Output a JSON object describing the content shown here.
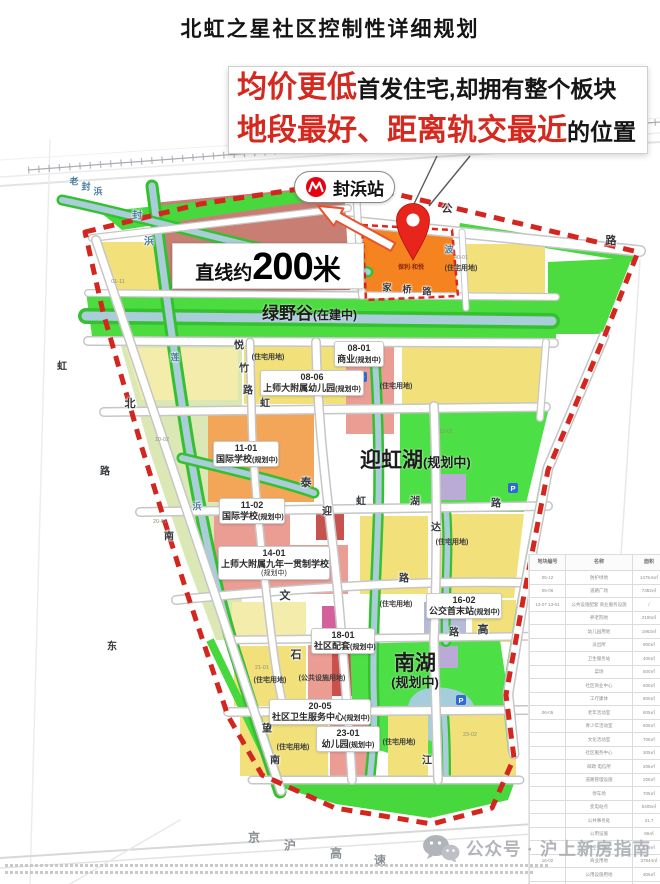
{
  "page_title": "北虹之星社区控制性详细规划",
  "callout": {
    "line1_red": "均价更低",
    "line1_black": "首发住宅,却拥有整个板块",
    "line2_red": "地段最好、距离轨交最近",
    "line2_black": "的位置"
  },
  "station": {
    "label": "封浜站"
  },
  "distance_box": {
    "prefix": "直线约",
    "number": "200",
    "unit": "米"
  },
  "area_labels": {
    "green_valley": {
      "name": "绿野谷",
      "status": "(在建中)"
    },
    "yinghong_lake": {
      "name": "迎虹湖",
      "status": "(规划中)"
    },
    "south_lake": {
      "name": "南湖",
      "status": "(规划中)"
    }
  },
  "highlight_parcel": {
    "text": "保利·和悦"
  },
  "parcel_labels": [
    {
      "code": "08-01",
      "name": "商业",
      "status": "(规划中)",
      "x": 334,
      "y": 341,
      "w": 50,
      "stack": false
    },
    {
      "code": "08-06",
      "name": "上师大附属幼儿园",
      "status": "(规划中)",
      "x": 260,
      "y": 370,
      "w": 104,
      "stack": false
    },
    {
      "code": "11-01",
      "name": "国际学校",
      "status": "(规划中)",
      "x": 213,
      "y": 441,
      "w": 66,
      "stack": false
    },
    {
      "code": "11-02",
      "name": "国际学校",
      "status": "(规划中)",
      "x": 219,
      "y": 498,
      "w": 66,
      "stack": false
    },
    {
      "code": "14-01",
      "name": "上师大附属九年一贯制学校",
      "status": "(规划中)",
      "x": 218,
      "y": 546,
      "w": 112,
      "stack": true
    },
    {
      "code": "16-02",
      "name": "公交首末站",
      "status": "(规划中)",
      "x": 426,
      "y": 593,
      "w": 76,
      "stack": false
    },
    {
      "code": "18-01",
      "name": "社区配套",
      "status": "(规划中)",
      "x": 311,
      "y": 628,
      "w": 64,
      "stack": false
    },
    {
      "code": "20-05",
      "name": "社区卫生服务中心",
      "status": "(规划中)",
      "x": 269,
      "y": 699,
      "w": 102,
      "stack": false
    },
    {
      "code": "23-01",
      "name": "幼儿园",
      "status": "(规划中)",
      "x": 316,
      "y": 726,
      "w": 64,
      "stack": false
    }
  ],
  "land_use_labels": [
    {
      "text": "(住宅用地)",
      "x": 268,
      "y": 357
    },
    {
      "text": "(住宅用地)",
      "x": 396,
      "y": 386
    },
    {
      "text": "(住宅用地)",
      "x": 461,
      "y": 268
    },
    {
      "text": "(住宅用地)",
      "x": 452,
      "y": 542
    },
    {
      "text": "(住宅用地)",
      "x": 396,
      "y": 604
    },
    {
      "text": "(住宅用地)",
      "x": 270,
      "y": 680
    },
    {
      "text": "(住宅用地)",
      "x": 293,
      "y": 747
    },
    {
      "text": "(住宅用地)",
      "x": 399,
      "y": 742
    },
    {
      "text": "(公共设施用地)",
      "x": 322,
      "y": 678
    }
  ],
  "parcel_codes": [
    [
      "01-11",
      118,
      282
    ],
    [
      "40-01",
      461,
      258
    ],
    [
      "10-02",
      162,
      440
    ],
    [
      "20-01",
      160,
      522
    ],
    [
      "12-01",
      446,
      432
    ],
    [
      "21-01",
      262,
      668
    ],
    [
      "23-02",
      470,
      735
    ]
  ],
  "road_chars": [
    {
      "c": "老",
      "x": 74,
      "y": 181,
      "s": 9,
      "w": true
    },
    {
      "c": "封",
      "x": 86,
      "y": 186,
      "s": 9,
      "w": true
    },
    {
      "c": "浜",
      "x": 98,
      "y": 191,
      "s": 9,
      "w": true
    },
    {
      "c": "封",
      "x": 137,
      "y": 214,
      "s": 10,
      "w": true
    },
    {
      "c": "浜",
      "x": 149,
      "y": 240,
      "s": 10,
      "w": true
    },
    {
      "c": "公",
      "x": 447,
      "y": 208,
      "s": 11
    },
    {
      "c": "路",
      "x": 611,
      "y": 240,
      "s": 11
    },
    {
      "c": "波",
      "x": 449,
      "y": 249,
      "s": 9,
      "w": true
    },
    {
      "c": "家",
      "x": 387,
      "y": 287,
      "s": 9
    },
    {
      "c": "桥",
      "x": 407,
      "y": 289,
      "s": 9
    },
    {
      "c": "路",
      "x": 427,
      "y": 291,
      "s": 9
    },
    {
      "c": "莲",
      "x": 175,
      "y": 357,
      "s": 9,
      "w": true
    },
    {
      "c": "浜",
      "x": 197,
      "y": 506,
      "s": 9,
      "w": true
    },
    {
      "c": "悦",
      "x": 239,
      "y": 344,
      "s": 10
    },
    {
      "c": "竹",
      "x": 244,
      "y": 367,
      "s": 10
    },
    {
      "c": "路",
      "x": 248,
      "y": 389,
      "s": 10
    },
    {
      "c": "虹",
      "x": 62,
      "y": 365,
      "s": 10
    },
    {
      "c": "路",
      "x": 105,
      "y": 470,
      "s": 10
    },
    {
      "c": "北",
      "x": 130,
      "y": 403,
      "s": 11
    },
    {
      "c": "南",
      "x": 169,
      "y": 535,
      "s": 10
    },
    {
      "c": "虹",
      "x": 265,
      "y": 402,
      "s": 10
    },
    {
      "c": "泰",
      "x": 306,
      "y": 482,
      "s": 11
    },
    {
      "c": "迎",
      "x": 327,
      "y": 510,
      "s": 10
    },
    {
      "c": "虹",
      "x": 361,
      "y": 500,
      "s": 10
    },
    {
      "c": "湖",
      "x": 415,
      "y": 500,
      "s": 10
    },
    {
      "c": "达",
      "x": 436,
      "y": 526,
      "s": 10
    },
    {
      "c": "路",
      "x": 496,
      "y": 502,
      "s": 10
    },
    {
      "c": "文",
      "x": 285,
      "y": 595,
      "s": 11
    },
    {
      "c": "路",
      "x": 404,
      "y": 577,
      "s": 10
    },
    {
      "c": "石",
      "x": 296,
      "y": 654,
      "s": 11
    },
    {
      "c": "高",
      "x": 483,
      "y": 629,
      "s": 11
    },
    {
      "c": "路",
      "x": 454,
      "y": 631,
      "s": 10
    },
    {
      "c": "望",
      "x": 267,
      "y": 727,
      "s": 10
    },
    {
      "c": "江",
      "x": 359,
      "y": 711,
      "s": 10
    },
    {
      "c": "江",
      "x": 427,
      "y": 759,
      "s": 10
    },
    {
      "c": "南",
      "x": 275,
      "y": 759,
      "s": 10
    },
    {
      "c": "东",
      "x": 112,
      "y": 645,
      "s": 10
    }
  ],
  "expressway_chars": [
    [
      "京",
      254,
      837
    ],
    [
      "沪",
      290,
      845
    ],
    [
      "高",
      336,
      853
    ],
    [
      "速",
      380,
      860
    ]
  ],
  "watermark": {
    "text": "公众号 · 沪上新房指南"
  },
  "legend": {
    "headers": [
      "地块编号",
      "名称",
      "面积"
    ],
    "rows": [
      {
        "a": "05-12",
        "b": "防护绿地",
        "c": "1479.6㎡"
      },
      {
        "a": "05-06",
        "b": "道路广场",
        "c": "7352㎡"
      },
      {
        "a": "13-07 13-01",
        "b": "公共设施配套 商业服务设施",
        "c": "/"
      },
      {
        "a": "",
        "b": "养老院地",
        "c": "2100㎡"
      },
      {
        "a": "",
        "b": "幼儿园用地",
        "c": "1963㎡"
      },
      {
        "a": "",
        "b": "派出所",
        "c": "900㎡"
      },
      {
        "a": "",
        "b": "卫生服务站",
        "c": "400㎡"
      },
      {
        "a": "",
        "b": "菜场",
        "c": "500㎡"
      },
      {
        "a": "",
        "b": "社区商业中心",
        "c": "600㎡"
      },
      {
        "a": "",
        "b": "工疗康体",
        "c": "800㎡"
      },
      {
        "a": "06-05",
        "b": "老年活动室",
        "c": "805㎡"
      },
      {
        "a": "",
        "b": "青少年活动室",
        "c": "505㎡"
      },
      {
        "a": "",
        "b": "文化活动室",
        "c": "705㎡"
      },
      {
        "a": "",
        "b": "社区服务中心",
        "c": "305㎡"
      },
      {
        "a": "",
        "b": "邮政 电信所",
        "c": "205㎡"
      },
      {
        "a": "",
        "b": "道路管理设施",
        "c": "205㎡"
      },
      {
        "a": "",
        "b": "停车场",
        "c": "705㎡"
      },
      {
        "a": "",
        "b": "变电站点",
        "c": "5405㎡"
      },
      {
        "a": "",
        "b": "公共事务处",
        "c": "41.7"
      },
      {
        "a": "",
        "b": "公用设施",
        "c": "86㎡"
      },
      {
        "a": "",
        "b": "环卫管理站",
        "c": "139㎡"
      },
      {
        "a": "16-02",
        "b": "商业用地",
        "c": "37844㎡"
      },
      {
        "a": "",
        "b": "公用设施用地",
        "c": "305㎡"
      },
      {
        "a": "",
        "b": "市政设施用地",
        "c": "1389㎡"
      }
    ]
  },
  "colors": {
    "accent_red": "#d5281e",
    "boundary_red": "#d2261e",
    "green": "#4cdc40",
    "water": "#a9cdd9",
    "yellow": "#f2e17a",
    "orange_highlight": "#f5831f",
    "salmon": "#eb9d94"
  }
}
